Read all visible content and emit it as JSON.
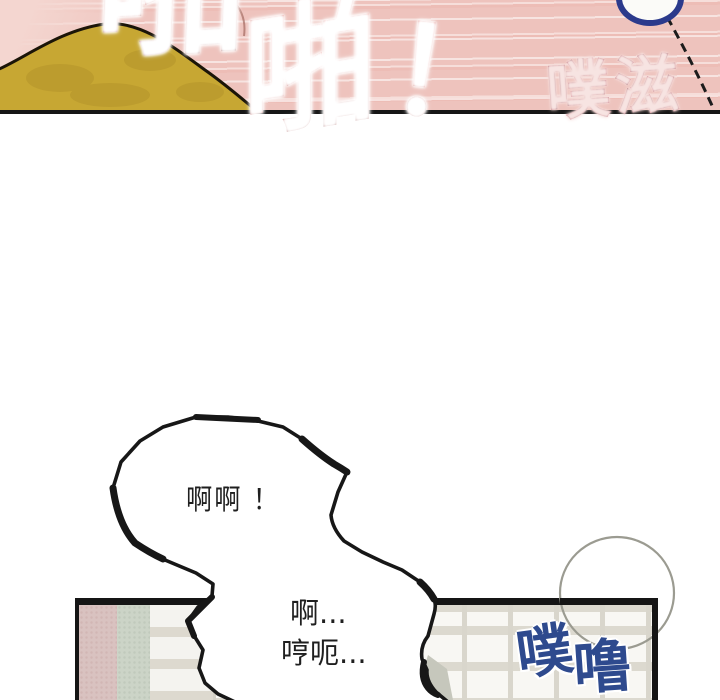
{
  "page": {
    "kind": "comic-page",
    "background": "#ffffff"
  },
  "top_panel": {
    "bg_pink": "#eec3bd",
    "mound_color": "#c7a733",
    "outline_color": "#171717",
    "blue_bubble_edge_color": "#2b3a8c",
    "sfx": {
      "pa_large": "啪",
      "pa_second": "啪",
      "exclamation": "！",
      "pa_color": "#cb2018",
      "puzi": "噗滋",
      "puzi_color": "#9c3346"
    }
  },
  "dialogue": {
    "bubble1_text": "啊啊 ！",
    "bubble2_line1": "啊...",
    "bubble2_line2": "哼呃...",
    "text_color": "#1f1f1f"
  },
  "bottom_panel": {
    "border_color": "#151515",
    "wall_bg": "#f8f7f3",
    "strip_pink": "#d9c2c0",
    "strip_green": "#ccd4c7",
    "grid_line_color": "#d9d6cc",
    "thought_circle_color": "#9b9b91",
    "sfx_pulu": {
      "char1": "噗",
      "char2": "噜",
      "color": "#2e4a8e"
    }
  }
}
